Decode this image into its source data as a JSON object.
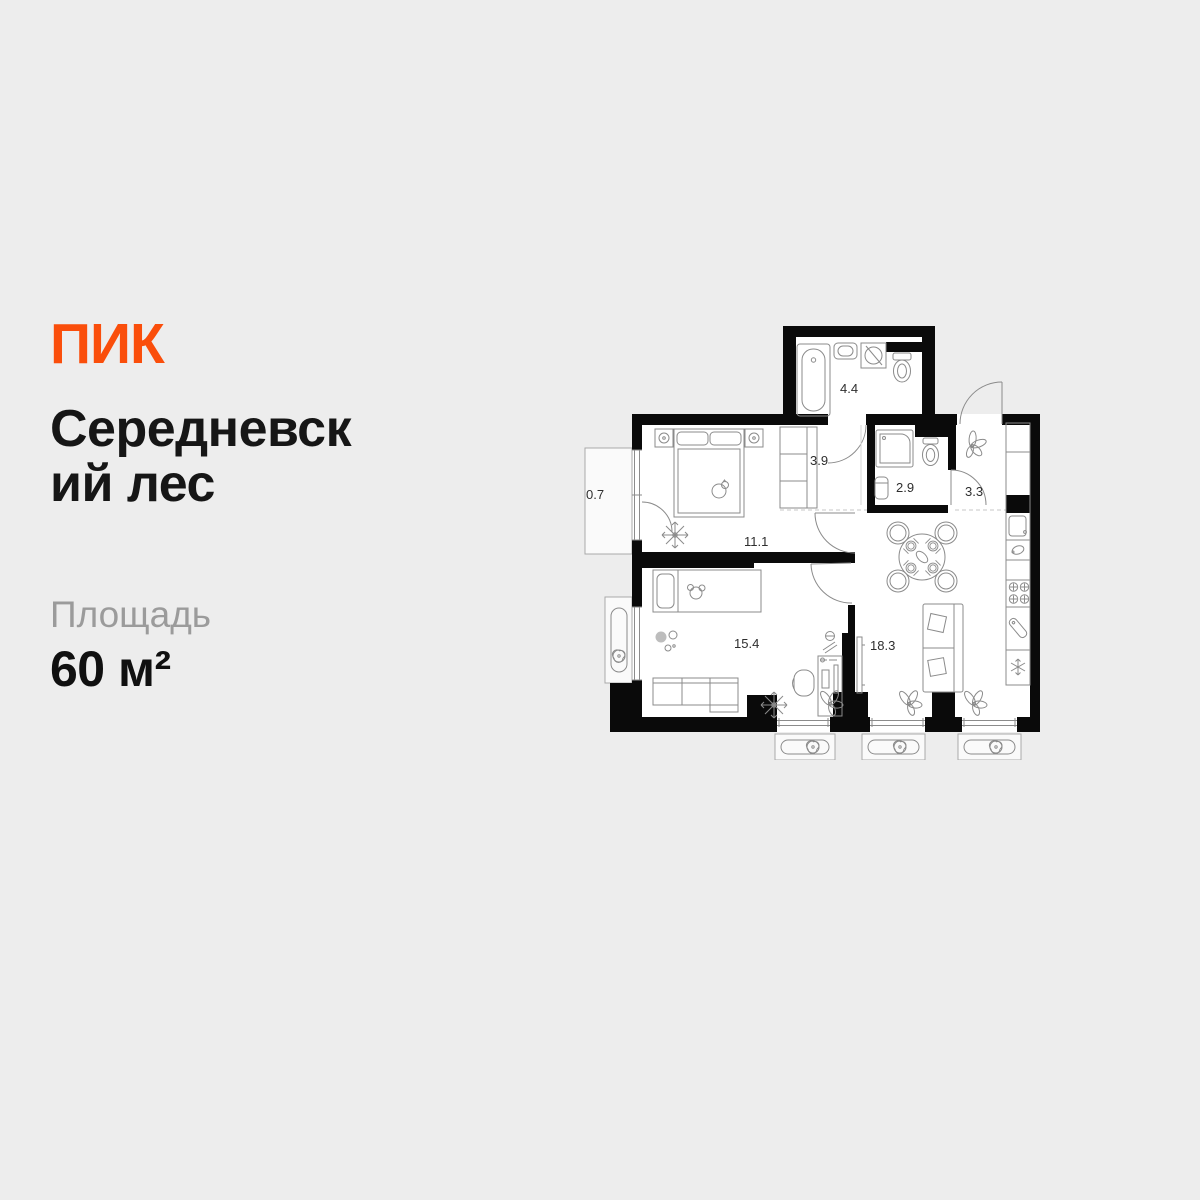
{
  "background_color": "#ededed",
  "brand": {
    "logo_text": "ПИК",
    "logo_color": "#fa4e0b"
  },
  "listing": {
    "title": "Середневский лес",
    "title_lines": [
      "Середневск",
      "ий лес"
    ],
    "area_label": "Площадь",
    "area_value": "60 м²"
  },
  "floorplan": {
    "wall_color": "#0a0a0a",
    "line_color": "#8b8b8b",
    "labels": {
      "bathroom": "4.4",
      "hallway": "3.9",
      "toilet": "2.9",
      "entry_hall": "3.3",
      "balcony": "0.7",
      "bedroom": "11.1",
      "kids_room": "15.4",
      "kitchen_living": "18.3"
    }
  }
}
